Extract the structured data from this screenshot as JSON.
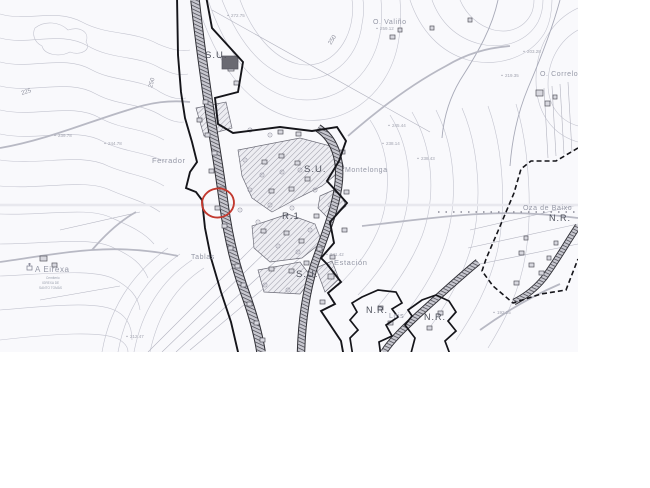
{
  "page": {
    "background": "#ffffff"
  },
  "map": {
    "type": "scanned-urban-planning-map",
    "region": {
      "width": 578,
      "height": 352
    },
    "colors": {
      "paper": "#f9f9fc",
      "contour": "#c3c4cf",
      "parcel": "#b3b4c0",
      "road_edge": "#2e2e34",
      "road_fill": "#c7c7cf",
      "boundary": "#15151a",
      "hatch_fill": "#ededf2",
      "annotation_red": "#c2392f"
    },
    "annotation_circle": {
      "cx": 218,
      "cy": 203,
      "rx": 16,
      "ry": 14.5,
      "rotation": -8
    },
    "labels": {
      "zones": [
        {
          "text": "S.U.",
          "x": 205,
          "y": 58,
          "size": 9.5
        },
        {
          "text": "S.U.",
          "x": 304,
          "y": 172,
          "size": 9.5
        },
        {
          "text": "S.U.",
          "x": 296,
          "y": 277,
          "size": 9.5
        },
        {
          "text": "R.1",
          "x": 282,
          "y": 219,
          "size": 9.5
        },
        {
          "text": "N.R.",
          "x": 366,
          "y": 313,
          "size": 9
        },
        {
          "text": "N.R.",
          "x": 424,
          "y": 320,
          "size": 9
        },
        {
          "text": "N.R.",
          "x": 549,
          "y": 221,
          "size": 9
        }
      ],
      "places": [
        {
          "text": "Ferrador",
          "x": 152,
          "y": 163,
          "size": 7.5
        },
        {
          "text": "O. Valiño",
          "x": 373,
          "y": 24,
          "size": 7
        },
        {
          "text": "O. Correlo",
          "x": 540,
          "y": 76,
          "size": 7
        },
        {
          "text": "Montelonga",
          "x": 345,
          "y": 172,
          "size": 7
        },
        {
          "text": "Estación",
          "x": 334,
          "y": 265,
          "size": 7.5
        },
        {
          "text": "Tablas",
          "x": 191,
          "y": 259,
          "size": 7
        },
        {
          "text": "A Eirexa",
          "x": 35,
          "y": 272,
          "size": 8
        },
        {
          "text": "Lois",
          "x": 389,
          "y": 318,
          "size": 7
        },
        {
          "text": "Oza de Baixo",
          "x": 523,
          "y": 210,
          "size": 7
        }
      ],
      "small_notes": [
        {
          "text": "Cemiterio",
          "x": 46,
          "y": 279,
          "size": 3.2
        },
        {
          "text": "IGREXA DE",
          "x": 42,
          "y": 284,
          "size": 3.2
        },
        {
          "text": "SANTO TOMÁS",
          "x": 39,
          "y": 289,
          "size": 3.2
        }
      ],
      "elevations": [
        {
          "text": "239.78",
          "x": 58,
          "y": 137
        },
        {
          "text": "244.78",
          "x": 108,
          "y": 145
        },
        {
          "text": "272.75",
          "x": 231,
          "y": 17
        },
        {
          "text": "259.12",
          "x": 380,
          "y": 30
        },
        {
          "text": "203.28",
          "x": 527,
          "y": 53
        },
        {
          "text": "219.35",
          "x": 505,
          "y": 77
        },
        {
          "text": "245.44",
          "x": 392,
          "y": 127
        },
        {
          "text": "238.14",
          "x": 386,
          "y": 145
        },
        {
          "text": "238.43",
          "x": 421,
          "y": 160
        },
        {
          "text": "241.42",
          "x": 330,
          "y": 256
        },
        {
          "text": "212.47",
          "x": 130,
          "y": 338
        },
        {
          "text": "192.25",
          "x": 497,
          "y": 314
        }
      ],
      "contour_values": [
        {
          "text": "225",
          "x": 22,
          "y": 95,
          "rot": -18,
          "size": 6
        },
        {
          "text": "250",
          "x": 152,
          "y": 88,
          "rot": -75,
          "size": 6
        },
        {
          "text": "250",
          "x": 331,
          "y": 45,
          "rot": -58,
          "size": 6
        }
      ]
    }
  }
}
